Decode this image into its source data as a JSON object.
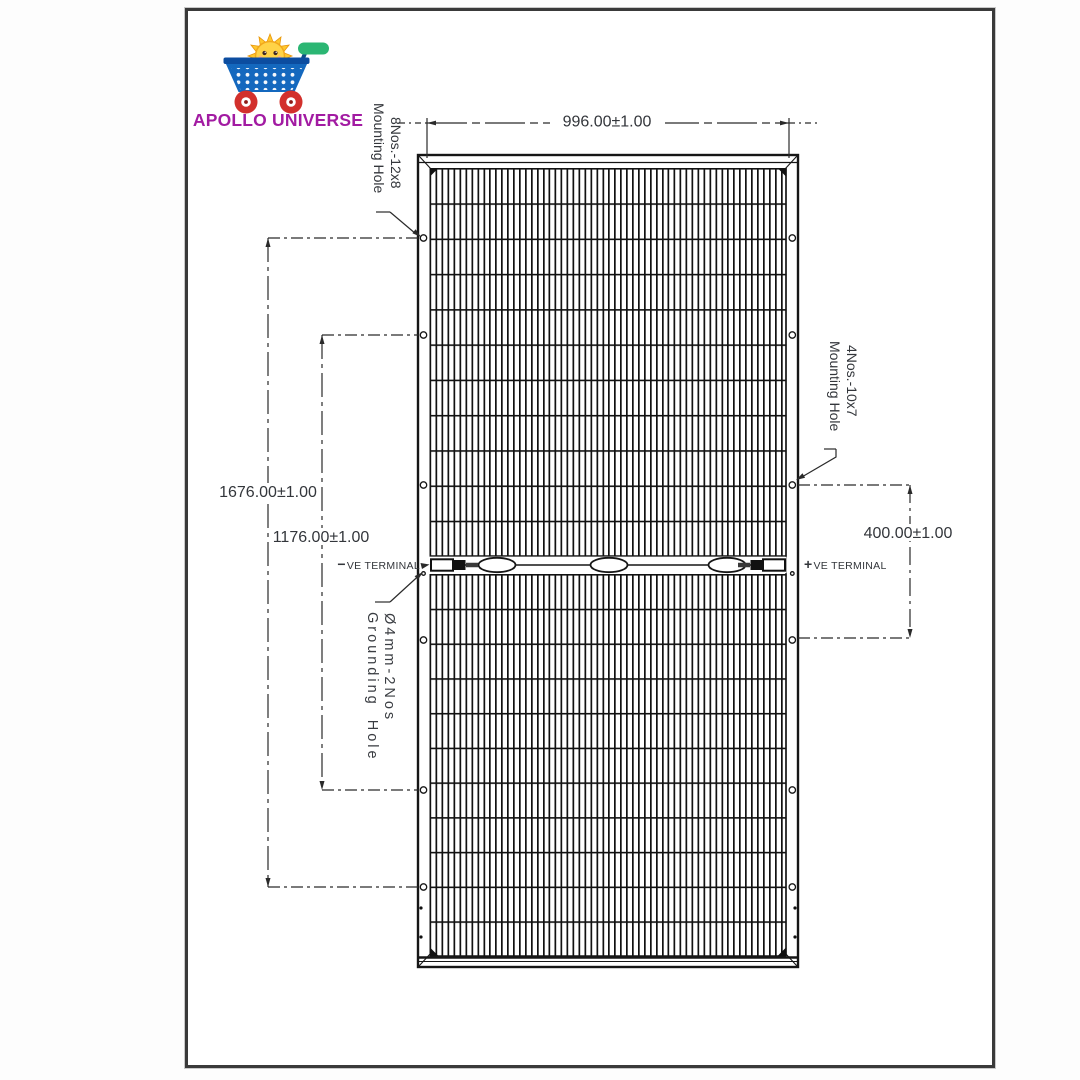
{
  "logo": {
    "brand": "APOLLO UNIVERSE",
    "cart_icon": "shopping-cart-with-sun",
    "colors": {
      "brand_text": "#a21ba2",
      "cart_blue": "#1468be",
      "wheel_red": "#d2302c",
      "handle_green": "#2bb673",
      "sun_yellow": "#ffd347"
    }
  },
  "drawing": {
    "dim_width": "996.00±1.00",
    "dim_height_outer": "1676.00±1.00",
    "dim_height_inner": "1176.00±1.00",
    "dim_right": "400.00±1.00",
    "label_mount_top": {
      "line1": "8Nos.-12x8",
      "line2": "Mounting Hole"
    },
    "label_mount_right": {
      "line1": "4Nos.-10x7",
      "line2": "Mounting Hole"
    },
    "label_grounding": {
      "line1": "Ø4mm-2Nos",
      "line2": "Grounding Hole"
    },
    "terminal_neg": {
      "sign": "−",
      "label": "VE TERMINAL"
    },
    "terminal_pos": {
      "sign": "+",
      "label": "VE TERMINAL"
    },
    "line_color": "#1f1f1f"
  }
}
